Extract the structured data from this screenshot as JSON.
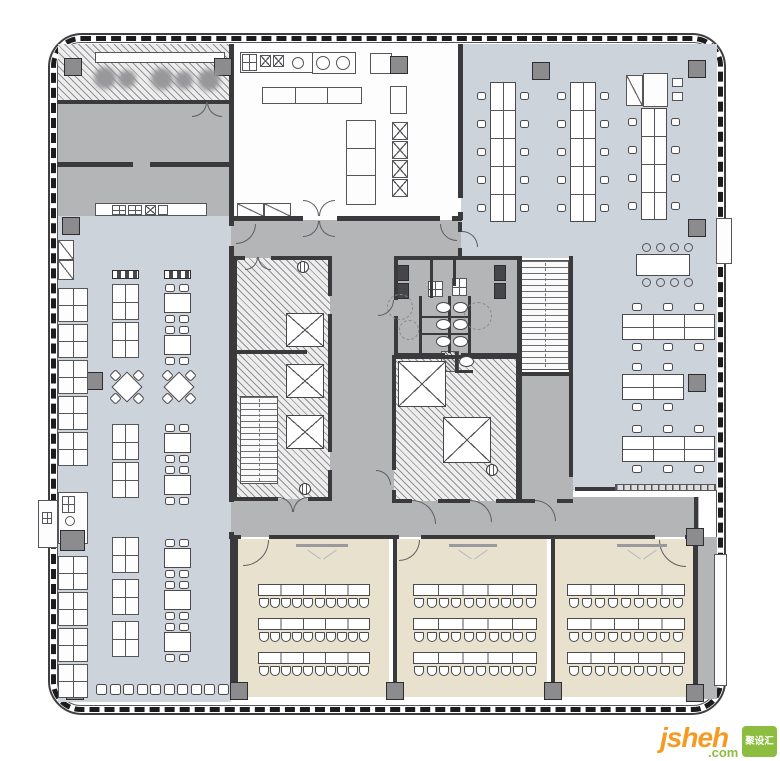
{
  "watermark": {
    "main": "jsheh",
    "suffix": ".com",
    "box_text": "聚设汇",
    "main_color": "#f59a23",
    "suffix_color": "#8cbd3e",
    "box_color": "#8cbd3e",
    "box_text_color": "#ffffff"
  },
  "palette": {
    "wall": "#3a3a3d",
    "floor_light": "#ccd3da",
    "floor_gray": "#b4b5b7",
    "floor_beige": "#e8e1ce",
    "floor_white": "#fdfdfd",
    "hatch_bg": "#ededed",
    "hatch_line": "#6a6a6e",
    "furniture_stroke": "#4a4a4e",
    "column_fill": "#8c8c8e",
    "dark_fixture": "#46464a",
    "watermark_orange": "#f59a23",
    "watermark_green": "#8cbd3e"
  },
  "outline": {
    "outer": [
      48,
      33,
      678,
      682
    ],
    "ticks": [
      51,
      36,
      672,
      676
    ],
    "inner": [
      57,
      42,
      660,
      664
    ]
  },
  "rooms": [
    {
      "name": "dining-hall",
      "r": [
        58,
        216,
        173,
        486
      ],
      "fill": "light"
    },
    {
      "name": "office-area",
      "r": [
        461,
        44,
        256,
        446
      ],
      "fill": "light"
    },
    {
      "name": "kitchen",
      "r": [
        231,
        44,
        229,
        176
      ],
      "fill": "white"
    },
    {
      "name": "private-room",
      "r": [
        58,
        102,
        173,
        62
      ],
      "fill": "gray"
    },
    {
      "name": "servery",
      "r": [
        58,
        164,
        173,
        52
      ],
      "fill": "gray"
    },
    {
      "name": "vestibule",
      "r": [
        231,
        220,
        230,
        40
      ],
      "fill": "gray"
    },
    {
      "name": "corridor-vertical",
      "r": [
        330,
        258,
        64,
        245
      ],
      "fill": "gray"
    },
    {
      "name": "corridor-bottom",
      "r": [
        231,
        497,
        468,
        40
      ],
      "fill": "gray"
    },
    {
      "name": "restrooms",
      "r": [
        394,
        258,
        126,
        97
      ],
      "fill": "gray"
    },
    {
      "name": "room-below-stair",
      "r": [
        519,
        374,
        54,
        129
      ],
      "fill": "gray"
    },
    {
      "name": "stair-shaft-right",
      "r": [
        519,
        258,
        52,
        114
      ],
      "fill": "white"
    },
    {
      "name": "terrace",
      "r": [
        58,
        44,
        173,
        58
      ],
      "fill": "hatch"
    },
    {
      "name": "core-left",
      "r": [
        235,
        258,
        95,
        241
      ],
      "fill": "hatch"
    },
    {
      "name": "core-right",
      "r": [
        394,
        357,
        124,
        144
      ],
      "fill": "hatch"
    },
    {
      "name": "classroom-1",
      "r": [
        237,
        539,
        152,
        158
      ],
      "fill": "beige"
    },
    {
      "name": "classroom-2",
      "r": [
        397,
        539,
        150,
        158
      ],
      "fill": "beige"
    },
    {
      "name": "classroom-3",
      "r": [
        555,
        539,
        138,
        158
      ],
      "fill": "beige"
    },
    {
      "name": "right-service-strip",
      "r": [
        695,
        537,
        22,
        162
      ],
      "fill": "gray"
    }
  ],
  "walls": [
    [
      229,
      44,
      5,
      60
    ],
    [
      229,
      104,
      5,
      112
    ],
    [
      229,
      216,
      5,
      10
    ],
    [
      229,
      246,
      5,
      256
    ],
    [
      229,
      532,
      5,
      7
    ],
    [
      230,
      539,
      8,
      158
    ],
    [
      57,
      100,
      174,
      4
    ],
    [
      57,
      162,
      76,
      5
    ],
    [
      150,
      162,
      81,
      5
    ],
    [
      458,
      44,
      5,
      154
    ],
    [
      458,
      212,
      5,
      8
    ],
    [
      231,
      216,
      72,
      5
    ],
    [
      337,
      216,
      103,
      5
    ],
    [
      452,
      216,
      10,
      5
    ],
    [
      458,
      222,
      4,
      10
    ],
    [
      458,
      248,
      4,
      12
    ],
    [
      233,
      256,
      12,
      4
    ],
    [
      271,
      256,
      61,
      4
    ],
    [
      233,
      256,
      4,
      245
    ],
    [
      328,
      256,
      4,
      40
    ],
    [
      328,
      314,
      4,
      138
    ],
    [
      328,
      470,
      4,
      31
    ],
    [
      233,
      497,
      45,
      4
    ],
    [
      308,
      497,
      24,
      4
    ],
    [
      237,
      350,
      70,
      4
    ],
    [
      394,
      256,
      128,
      4
    ],
    [
      394,
      256,
      4,
      44
    ],
    [
      394,
      316,
      4,
      41
    ],
    [
      394,
      353,
      51,
      4
    ],
    [
      461,
      353,
      61,
      4
    ],
    [
      430,
      258,
      3,
      40
    ],
    [
      453,
      258,
      3,
      28
    ],
    [
      448,
      296,
      3,
      57
    ],
    [
      419,
      296,
      3,
      57
    ],
    [
      468,
      296,
      3,
      57
    ],
    [
      419,
      316,
      49,
      2
    ],
    [
      419,
      333,
      49,
      2
    ],
    [
      455,
      352,
      3,
      20
    ],
    [
      455,
      370,
      18,
      3
    ],
    [
      392,
      355,
      126,
      4
    ],
    [
      392,
      355,
      4,
      115
    ],
    [
      392,
      490,
      4,
      13
    ],
    [
      516,
      355,
      4,
      148
    ],
    [
      392,
      499,
      20,
      4
    ],
    [
      438,
      499,
      32,
      4
    ],
    [
      496,
      499,
      22,
      4
    ],
    [
      517,
      256,
      5,
      247
    ],
    [
      569,
      256,
      4,
      118
    ],
    [
      519,
      372,
      52,
      4
    ],
    [
      569,
      374,
      4,
      103
    ],
    [
      519,
      499,
      16,
      4
    ],
    [
      557,
      499,
      16,
      4
    ],
    [
      575,
      487,
      40,
      4
    ],
    [
      231,
      535,
      10,
      4
    ],
    [
      269,
      535,
      130,
      4
    ],
    [
      421,
      535,
      234,
      4
    ],
    [
      685,
      535,
      14,
      4
    ],
    [
      393,
      539,
      4,
      158
    ],
    [
      551,
      539,
      4,
      158
    ],
    [
      693,
      539,
      5,
      158
    ],
    [
      694,
      497,
      4,
      42
    ]
  ],
  "columns": [
    [
      64,
      58
    ],
    [
      214,
      58
    ],
    [
      390,
      56
    ],
    [
      532,
      62
    ],
    [
      688,
      60
    ],
    [
      62,
      217
    ],
    [
      688,
      219
    ],
    [
      85,
      372
    ],
    [
      688,
      374
    ],
    [
      686,
      528
    ],
    [
      66,
      682
    ],
    [
      230,
      682
    ],
    [
      386,
      682
    ],
    [
      544,
      682
    ],
    [
      686,
      684
    ]
  ],
  "boxes": [
    {
      "n": "terrace-canopy-band",
      "r": [
        95,
        52,
        130,
        11
      ],
      "s": ""
    },
    {
      "n": "west-bay",
      "r": [
        38,
        500,
        20,
        48
      ],
      "s": ""
    },
    {
      "n": "west-bay-unit",
      "r": [
        42,
        512,
        10,
        12
      ],
      "s": "grid2x2"
    },
    {
      "n": "east-bay-upper",
      "r": [
        716,
        218,
        16,
        46
      ],
      "s": ""
    },
    {
      "n": "east-bay-lower",
      "r": [
        714,
        554,
        13,
        132
      ],
      "s": ""
    },
    {
      "n": "kitchen-counter",
      "r": [
        240,
        52,
        116,
        21
      ],
      "s": ""
    },
    {
      "n": "kitchen-sink",
      "r": [
        242,
        54,
        15,
        17
      ],
      "s": "grid2x2"
    },
    {
      "n": "kitchen-burner",
      "r": [
        260,
        55,
        11,
        12
      ],
      "s": "xmark"
    },
    {
      "n": "kitchen-burner",
      "r": [
        273,
        55,
        11,
        12
      ],
      "s": "xmark"
    },
    {
      "n": "kitchen-range",
      "r": [
        312,
        52,
        44,
        22
      ],
      "s": ""
    },
    {
      "n": "kitchen-equipment",
      "r": [
        370,
        53,
        22,
        21
      ],
      "s": ""
    },
    {
      "n": "kitchen-equipment",
      "r": [
        390,
        86,
        17,
        28
      ],
      "s": ""
    },
    {
      "n": "kitchen-island",
      "r": [
        262,
        87,
        100,
        17
      ],
      "s": "seg3v"
    },
    {
      "n": "kitchen-tall-counter",
      "r": [
        346,
        120,
        30,
        85
      ],
      "s": "seg3h"
    },
    {
      "n": "kitchen-cooker",
      "r": [
        392,
        122,
        16,
        18
      ],
      "s": "xmark"
    },
    {
      "n": "kitchen-cooker",
      "r": [
        392,
        141,
        16,
        18
      ],
      "s": "xmark"
    },
    {
      "n": "kitchen-cooker",
      "r": [
        392,
        160,
        16,
        18
      ],
      "s": "xmark"
    },
    {
      "n": "kitchen-cooker",
      "r": [
        392,
        179,
        16,
        18
      ],
      "s": "xmark"
    },
    {
      "n": "kitchen-counter-low",
      "r": [
        237,
        203,
        27,
        14
      ],
      "s": "diag"
    },
    {
      "n": "kitchen-counter-low",
      "r": [
        264,
        203,
        27,
        14
      ],
      "s": "diag"
    },
    {
      "n": "servery-counter",
      "r": [
        95,
        203,
        112,
        13
      ],
      "s": ""
    },
    {
      "n": "servery-appliance",
      "r": [
        112,
        205,
        14,
        10
      ],
      "s": "grid2x2"
    },
    {
      "n": "servery-appliance",
      "r": [
        128,
        205,
        14,
        10
      ],
      "s": "grid2x2"
    },
    {
      "n": "servery-appliance",
      "r": [
        145,
        205,
        11,
        10
      ],
      "s": "xmark"
    },
    {
      "n": "servery-appliance",
      "r": [
        158,
        205,
        10,
        10
      ],
      "s": ""
    },
    {
      "n": "dining-cabinet",
      "r": [
        58,
        240,
        16,
        20
      ],
      "s": "diag"
    },
    {
      "n": "dining-cabinet",
      "r": [
        58,
        260,
        16,
        20
      ],
      "s": "diag"
    },
    {
      "n": "dining-niche",
      "r": [
        58,
        492,
        30,
        52
      ],
      "s": ""
    },
    {
      "n": "dining-niche-unit",
      "r": [
        62,
        496,
        13,
        17
      ],
      "s": "grid2x2"
    },
    {
      "n": "office-cabinet",
      "r": [
        626,
        75,
        17,
        31
      ],
      "s": "diag"
    },
    {
      "n": "office-l-desk",
      "r": [
        643,
        73,
        25,
        34
      ],
      "s": ""
    },
    {
      "n": "office-printer",
      "r": [
        672,
        78,
        11,
        9
      ],
      "s": ""
    },
    {
      "n": "office-printer",
      "r": [
        672,
        92,
        11,
        9
      ],
      "s": ""
    },
    {
      "n": "restroom-sink",
      "r": [
        428,
        281,
        15,
        16
      ],
      "s": "grid2x2"
    },
    {
      "n": "restroom-sink",
      "r": [
        452,
        278,
        15,
        18
      ],
      "s": "grid2x2"
    }
  ],
  "dark_boxes": [
    {
      "n": "urinal",
      "r": [
        397,
        265,
        12,
        16
      ]
    },
    {
      "n": "urinal",
      "r": [
        397,
        283,
        12,
        16
      ]
    },
    {
      "n": "urinal",
      "r": [
        494,
        265,
        12,
        16
      ]
    },
    {
      "n": "urinal",
      "r": [
        494,
        283,
        12,
        16
      ]
    }
  ],
  "gray_boxes": [
    {
      "n": "niche-equipment",
      "r": [
        60,
        530,
        25,
        21
      ]
    }
  ],
  "hatch_boxes": [
    {
      "n": "duct-shaft",
      "r": [
        441,
        351,
        18,
        21
      ]
    }
  ],
  "partitions": [
    {
      "n": "office-low-partition",
      "r": [
        615,
        484,
        101,
        7
      ]
    }
  ],
  "stairs": [
    {
      "n": "stair-core-left",
      "r": [
        240,
        396,
        38,
        88
      ]
    },
    {
      "n": "stair-right",
      "r": [
        521,
        260,
        48,
        110
      ]
    }
  ],
  "elevators": [
    [
      286,
      313,
      38,
      34
    ],
    [
      286,
      364,
      38,
      34
    ],
    [
      286,
      415,
      38,
      34
    ],
    [
      398,
      361,
      48,
      46
    ],
    [
      443,
      417,
      48,
      46
    ]
  ],
  "toilets": [
    [
      436,
      302
    ],
    [
      453,
      302
    ],
    [
      436,
      319
    ],
    [
      453,
      319
    ],
    [
      436,
      336
    ],
    [
      453,
      336
    ],
    [
      459,
      356
    ]
  ],
  "circles": [
    {
      "n": "prep-sink",
      "c": [
        298,
        63,
        6
      ],
      "s": ""
    },
    {
      "n": "wok-burner",
      "c": [
        323,
        63,
        7
      ],
      "s": ""
    },
    {
      "n": "wok-burner",
      "c": [
        343,
        63,
        7
      ],
      "s": ""
    },
    {
      "n": "floor-drain",
      "c": [
        400,
        307,
        13
      ],
      "s": "dashed"
    },
    {
      "n": "floor-drain",
      "c": [
        409,
        330,
        10
      ],
      "s": "dashed"
    },
    {
      "n": "floor-drain",
      "c": [
        478,
        316,
        14
      ],
      "s": "dashed"
    },
    {
      "n": "niche-fixture",
      "c": [
        70,
        521,
        5
      ],
      "s": ""
    },
    {
      "n": "terrace-table",
      "c": [
        105,
        78,
        11
      ],
      "s": "blur"
    },
    {
      "n": "terrace-table",
      "c": [
        127,
        79,
        9
      ],
      "s": "blur"
    },
    {
      "n": "terrace-table",
      "c": [
        162,
        79,
        11
      ],
      "s": "blur"
    },
    {
      "n": "terrace-table",
      "c": [
        184,
        80,
        9
      ],
      "s": "blur"
    },
    {
      "n": "terrace-table",
      "c": [
        209,
        80,
        11
      ],
      "s": "blur"
    }
  ],
  "doors": [
    [
      236,
      224,
      20,
      "br"
    ],
    [
      303,
      221,
      16,
      "br"
    ],
    [
      319,
      221,
      16,
      "bl"
    ],
    [
      440,
      224,
      17,
      "bl"
    ],
    [
      462,
      231,
      16,
      "tr"
    ],
    [
      303,
      200,
      16,
      "tr"
    ],
    [
      319,
      200,
      16,
      "tl"
    ],
    [
      192,
      102,
      15,
      "br"
    ],
    [
      207,
      102,
      15,
      "bl"
    ],
    [
      245,
      257,
      13,
      "br"
    ],
    [
      258,
      257,
      13,
      "bl"
    ],
    [
      278,
      497,
      15,
      "tr"
    ],
    [
      293,
      497,
      15,
      "tl"
    ],
    [
      378,
      300,
      16,
      "br"
    ],
    [
      412,
      500,
      24,
      "tr"
    ],
    [
      470,
      500,
      22,
      "tr"
    ],
    [
      535,
      500,
      21,
      "tr"
    ],
    [
      243,
      540,
      26,
      "br"
    ],
    [
      399,
      540,
      21,
      "br"
    ],
    [
      659,
      540,
      27,
      "bl"
    ],
    [
      376,
      470,
      15,
      "tr"
    ]
  ],
  "markers": [
    [
      297,
      261
    ],
    [
      299,
      483
    ],
    [
      486,
      464
    ]
  ],
  "office": {
    "desk_columns": [
      {
        "x": 490,
        "y": 82,
        "segs": 5
      },
      {
        "x": 570,
        "y": 82,
        "segs": 5
      },
      {
        "x": 641,
        "y": 108,
        "segs": 4
      }
    ],
    "desk_rows": [
      {
        "x": 622,
        "y": 314,
        "segs": 3
      },
      {
        "x": 622,
        "y": 374,
        "segs": 2
      },
      {
        "x": 622,
        "y": 436,
        "segs": 3
      }
    ],
    "conference": {
      "x": 636,
      "y": 254,
      "w": 54,
      "h": 22,
      "chairs_top": 4,
      "chairs_bottom": 4
    }
  },
  "classrooms": {
    "row_ys": [
      584,
      618,
      652
    ],
    "rooms": [
      {
        "tx": 258,
        "tw": 112,
        "seats": 10
      },
      {
        "tx": 413,
        "tw": 124,
        "seats": 10
      },
      {
        "tx": 567,
        "tw": 118,
        "seats": 9
      }
    ],
    "screens": [
      [
        296,
        544,
        52
      ],
      [
        449,
        544,
        48
      ],
      [
        617,
        544,
        50
      ]
    ]
  },
  "dining": {
    "benches": [
      [
        112,
        270
      ],
      [
        164,
        270
      ]
    ],
    "tables_a_x": 112,
    "tables_a_ys": [
      284,
      322,
      424,
      462,
      537,
      579,
      621
    ],
    "tables_b_x": 164,
    "tables_b_ys": [
      284,
      326,
      424,
      466,
      539,
      581,
      623
    ],
    "diamonds": [
      [
        112,
        372
      ],
      [
        164,
        372
      ]
    ],
    "booth_x": 58,
    "booth_ys": [
      288,
      324,
      360,
      396,
      432,
      556,
      592,
      628,
      664
    ],
    "chair_row": {
      "y": 684,
      "x0": 96,
      "count": 10,
      "step": 13.5
    }
  }
}
